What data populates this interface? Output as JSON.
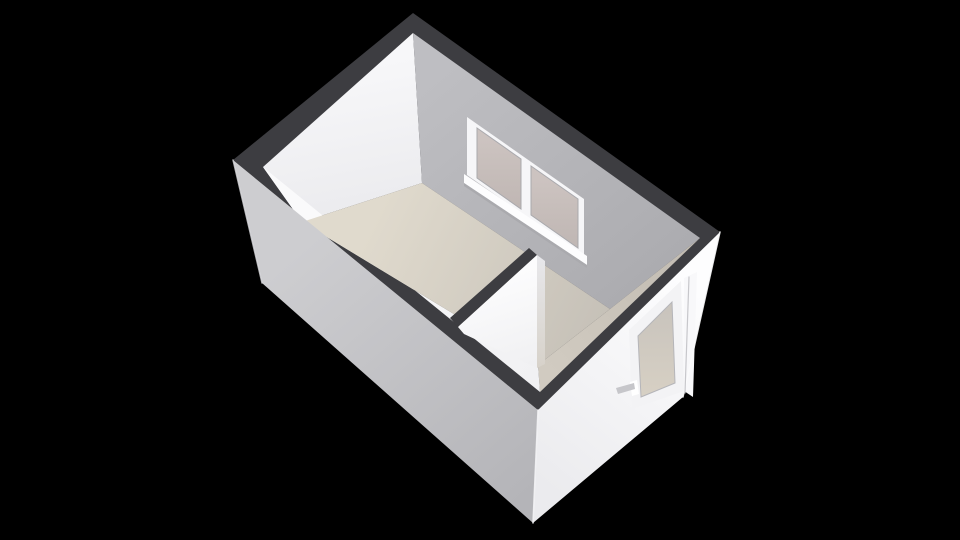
{
  "meta": {
    "view_label": "3d-floorplan-view",
    "canvas": {
      "width": 960,
      "height": 540
    },
    "background_color": "#000000"
  },
  "palette": {
    "wall_top_dark": "#3d3d41",
    "interior_white_wall": "#f4f4f6",
    "interior_gray_wall": "#b4b4b8",
    "floor_beige": "#ded8cc",
    "exterior_gray": "#c6c6ca",
    "exterior_white": "#f7f7f9",
    "glass_tint": "#c8bfbc",
    "fixture_white": "#ffffff",
    "handle_gray": "#c6c6ca"
  },
  "scene": {
    "faces": [
      {
        "name": "wall-top-ring",
        "points": [
          [
            413,
            13
          ],
          [
            720,
            232
          ],
          [
            538,
            410
          ],
          [
            233,
            160
          ]
        ],
        "fill": "#3d3d41"
      },
      {
        "name": "interior-wall-left",
        "points": [
          [
            263,
            167
          ],
          [
            413,
            33
          ],
          [
            422,
            183
          ],
          [
            302,
            222
          ]
        ],
        "gradient": {
          "x1": 340,
          "y1": 70,
          "x2": 370,
          "y2": 225,
          "stops": [
            "#f7f7f9",
            "#eaeaed"
          ]
        }
      },
      {
        "name": "interior-wall-window",
        "points": [
          [
            413,
            33
          ],
          [
            700,
            238
          ],
          [
            610,
            309
          ],
          [
            422,
            183
          ]
        ],
        "gradient": {
          "x1": 450,
          "y1": 60,
          "x2": 650,
          "y2": 300,
          "stops": [
            "#bebec2",
            "#abofix"
          ]
        },
        "gradient_fix": true
      },
      {
        "name": "interior-strip-front-right",
        "points": [
          [
            700,
            238
          ],
          [
            540,
            392
          ],
          [
            538,
            365
          ],
          [
            610,
            309
          ]
        ],
        "gradient": {
          "x1": 690,
          "y1": 250,
          "x2": 555,
          "y2": 375,
          "stops": [
            "#c2bcb2",
            "#d1cbc1"
          ]
        }
      },
      {
        "name": "interior-strip-front-left",
        "points": [
          [
            540,
            392
          ],
          [
            263,
            167
          ],
          [
            302,
            222
          ],
          [
            538,
            365
          ]
        ],
        "gradient": {
          "x1": 330,
          "y1": 200,
          "x2": 530,
          "y2": 380,
          "stops": [
            "#fafafb",
            "#f1f1f3"
          ]
        }
      },
      {
        "name": "room-floor",
        "points": [
          [
            422,
            183
          ],
          [
            610,
            309
          ],
          [
            538,
            365
          ],
          [
            302,
            222
          ]
        ],
        "gradient": {
          "x1": 380,
          "y1": 205,
          "x2": 605,
          "y2": 315,
          "stops": [
            "#e0dacd",
            "#c6c1b8"
          ]
        }
      },
      {
        "name": "window-frame",
        "points": [
          [
            467,
            117
          ],
          [
            584,
            199
          ],
          [
            584,
            257
          ],
          [
            467,
            175
          ]
        ],
        "fill": "#f6f6f8"
      },
      {
        "name": "window-sill",
        "points": [
          [
            464,
            174
          ],
          [
            587,
            256
          ],
          [
            587,
            265
          ],
          [
            464,
            183
          ]
        ],
        "fill": "#fdfdfe"
      },
      {
        "name": "window-sill-shadow",
        "points": [
          [
            464,
            183
          ],
          [
            587,
            265
          ],
          [
            587,
            268
          ],
          [
            464,
            186
          ]
        ],
        "fill": "#aaaaae"
      },
      {
        "name": "window-pane-left",
        "points": [
          [
            477,
            128
          ],
          [
            521,
            159
          ],
          [
            521,
            209
          ],
          [
            477,
            178
          ]
        ],
        "gradient": {
          "x1": 499,
          "y1": 140,
          "x2": 499,
          "y2": 205,
          "stops": [
            "#ccc3c0",
            "#c0b7b4"
          ]
        },
        "stroke": "#a9a9ad",
        "stroke_width": 1
      },
      {
        "name": "window-pane-right",
        "points": [
          [
            531,
            166
          ],
          [
            578,
            199
          ],
          [
            578,
            248
          ],
          [
            531,
            215
          ]
        ],
        "gradient": {
          "x1": 554,
          "y1": 180,
          "x2": 554,
          "y2": 243,
          "stops": [
            "#ccc3c0",
            "#c0b7b4"
          ]
        },
        "stroke": "#a9a9ad",
        "stroke_width": 1
      },
      {
        "name": "partition-wall-top",
        "points": [
          [
            450,
            318
          ],
          [
            529,
            248
          ],
          [
            537,
            255
          ],
          [
            458,
            327
          ]
        ],
        "fill": "#3d3d41"
      },
      {
        "name": "partition-wall-face",
        "points": [
          [
            458,
            327
          ],
          [
            537,
            255
          ],
          [
            537,
            368
          ],
          [
            464,
            334
          ]
        ],
        "gradient": {
          "x1": 490,
          "y1": 280,
          "x2": 520,
          "y2": 370,
          "stops": [
            "#fcfcfd",
            "#f0f0f2"
          ]
        }
      },
      {
        "name": "partition-wall-end",
        "points": [
          [
            537,
            255
          ],
          [
            545,
            261
          ],
          [
            545,
            364
          ],
          [
            537,
            368
          ]
        ],
        "gradient": {
          "x1": 541,
          "y1": 260,
          "x2": 541,
          "y2": 366,
          "stops": [
            "#e7e7ea",
            "#d7d2ca"
          ]
        }
      },
      {
        "name": "exterior-wall-left",
        "points": [
          [
            233,
            160
          ],
          [
            538,
            410
          ],
          [
            533,
            523
          ],
          [
            262,
            283
          ]
        ],
        "gradient": {
          "x1": 300,
          "y1": 250,
          "x2": 520,
          "y2": 505,
          "stops": [
            "#cdcdd0",
            "#b4b4b8"
          ]
        }
      },
      {
        "name": "exterior-wall-right",
        "points": [
          [
            538,
            410
          ],
          [
            720,
            232
          ],
          [
            683,
            397
          ],
          [
            533,
            523
          ]
        ],
        "gradient": {
          "x1": 695,
          "y1": 290,
          "x2": 545,
          "y2": 485,
          "stops": [
            "#fdfdfe",
            "#ebebee"
          ]
        }
      },
      {
        "name": "door-frame",
        "points": [
          [
            629,
            330
          ],
          [
            681,
            281
          ],
          [
            684,
            391
          ],
          [
            632,
            409
          ]
        ],
        "fill": "#f3f3f5"
      },
      {
        "name": "door-glass",
        "points": [
          [
            638,
            336
          ],
          [
            672,
            302
          ],
          [
            675,
            383
          ],
          [
            641,
            397
          ]
        ],
        "gradient": {
          "x1": 656,
          "y1": 310,
          "x2": 658,
          "y2": 395,
          "stops": [
            "#c9c4bd",
            "#d7d0c4"
          ]
        },
        "stroke": "#b5b5b9",
        "stroke_width": 1
      },
      {
        "name": "door-side-trim",
        "points": [
          [
            684,
            278
          ],
          [
            697,
            272
          ],
          [
            693,
            397
          ],
          [
            684,
            391
          ]
        ],
        "fill": "#f8f8fa"
      },
      {
        "name": "door-handle-mount",
        "points": [
          [
            630,
            382
          ],
          [
            637,
            380
          ],
          [
            639,
            394
          ],
          [
            632,
            396
          ]
        ],
        "fill": "#ffffff"
      },
      {
        "name": "door-handle-lever",
        "points": [
          [
            616,
            388
          ],
          [
            634,
            383
          ],
          [
            635,
            389
          ],
          [
            618,
            394
          ]
        ],
        "fill": "#c6c6ca"
      }
    ],
    "edges": [
      {
        "name": "corner-highlight-west",
        "x1": 233,
        "y1": 160,
        "x2": 262,
        "y2": 283,
        "stroke": "#d9d9dd",
        "width": 1.5,
        "opacity": 0.8
      },
      {
        "name": "corner-highlight-south",
        "x1": 538,
        "y1": 410,
        "x2": 533,
        "y2": 523,
        "stroke": "#f4f4f6",
        "width": 1.5,
        "opacity": 0.9
      },
      {
        "name": "corner-highlight-east",
        "x1": 720,
        "y1": 232,
        "x2": 683,
        "y2": 397,
        "stroke": "#fbfbfc",
        "width": 1.5,
        "opacity": 0.9
      },
      {
        "name": "door-trim-seam",
        "x1": 689,
        "y1": 277,
        "x2": 685,
        "y2": 393,
        "stroke": "#c7c7cb",
        "width": 1.2,
        "opacity": 1
      }
    ]
  }
}
